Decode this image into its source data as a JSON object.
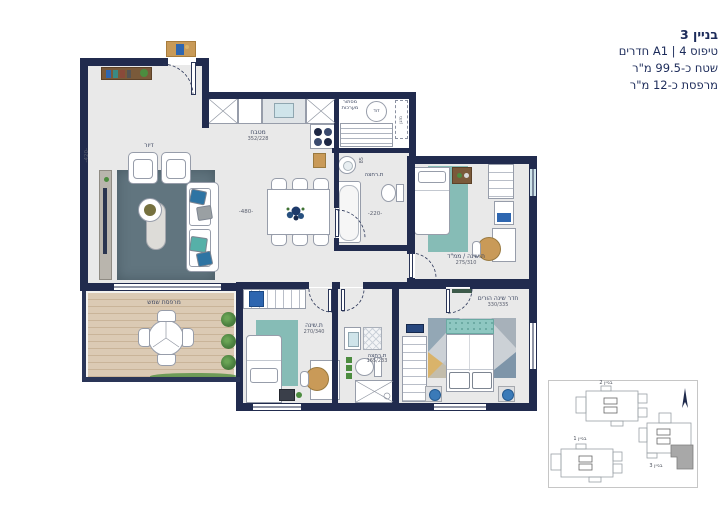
{
  "title": {
    "line1": "בניין 3",
    "line2": "טיפוס A1 | 4 חדרים",
    "line3": "שטח כ-99.5 מ\"ר",
    "line4": "מרפסת כ-12 מ\"ר"
  },
  "rooms": {
    "living": {
      "label": "דיור",
      "dim_height": "-420-",
      "dim_width": "-480-"
    },
    "kitchen": {
      "label": "מטבח",
      "dims": "352/228"
    },
    "systems": {
      "label_line1": "מסתור",
      "label_line2": "מערכות",
      "boiler": "דוד",
      "ac": "מזגן"
    },
    "bath1": {
      "label": "ת.רחצה",
      "dim_width": "-220-",
      "dim_small": "85"
    },
    "mamad": {
      "label": "ת.שינה / ממ\"ד",
      "dims": "275/310"
    },
    "bedroom2": {
      "label": "ת.שינה",
      "dims": "270/340"
    },
    "bath2": {
      "label": "ת.רחצה",
      "dims": "165/233"
    },
    "master": {
      "label": "חדר שינה הורים",
      "dims": "330/335"
    },
    "balcony": {
      "label": "מרפסת שמש"
    }
  },
  "keyplan": {
    "building1": "בניין 1",
    "building2": "בניין 2",
    "building3": "בניין 3"
  },
  "colors": {
    "wall": "#212b4e",
    "floor": "#e9e9e9",
    "rug_teal": "#86bcb6",
    "rug_slate": "#61757f",
    "accent_blue": "#2e66b0",
    "deck_wood": "#d9c8b1",
    "title_text": "#1c2b5a",
    "keyplan_highlight": "#a8a8a8"
  }
}
